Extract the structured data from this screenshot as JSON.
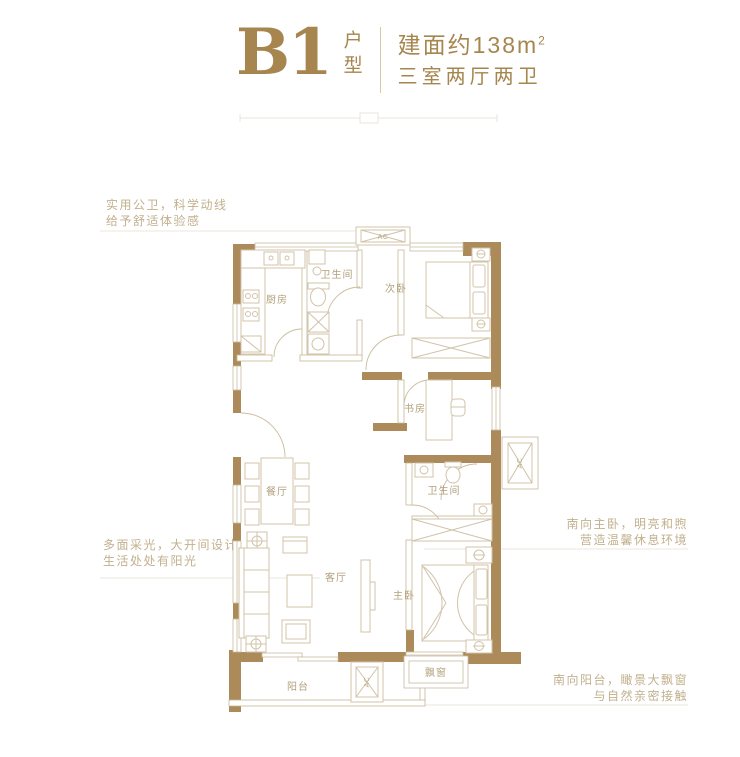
{
  "header": {
    "code": "B1",
    "code_suffix": "户型",
    "area_label": "建面约138m",
    "area_sup": "2",
    "layout": "三室两厅两卫"
  },
  "annotations": {
    "left_top": {
      "line1": "实用公卫，科学动线",
      "line2": "给予舒适体验感"
    },
    "left_bottom": {
      "line1": "多面采光，大开间设计",
      "line2": "生活处处有阳光"
    },
    "right_top": {
      "line1": "南向主卧，明亮和煦",
      "line2": "营造温馨休息环境"
    },
    "right_bottom": {
      "line1": "南向阳台，瞰景大飘窗",
      "line2": "与自然亲密接触"
    }
  },
  "plan": {
    "rooms": {
      "kitchen": "厨房",
      "bath_top": "卫生间",
      "bedroom2": "次卧",
      "study": "书房",
      "dining": "餐厅",
      "living": "客厅",
      "bath_bottom": "卫生间",
      "master": "主卧",
      "bay_window": "飘窗",
      "balcony": "阳台"
    },
    "ac_label": "AC"
  },
  "colors": {
    "accent": "#A6854E",
    "wall": "#AC8A59",
    "furniture_line": "#D0C3AA",
    "room_label": "#B3A17C",
    "annotation_text": "#C2B08D"
  }
}
